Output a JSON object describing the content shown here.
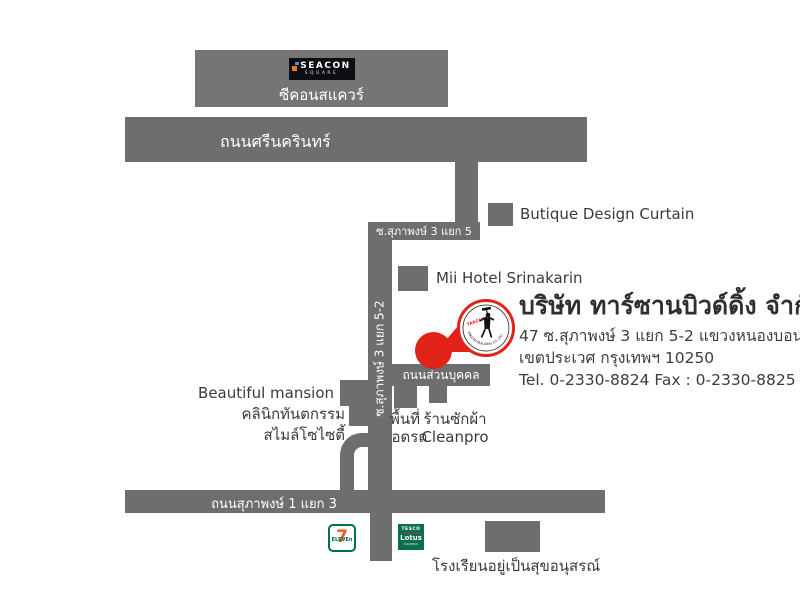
{
  "colors": {
    "road": "#6e6e6e",
    "marker_red": "#e2231a",
    "text_dark": "#3a3a3a",
    "seven_green": "#00703c",
    "seven_orange": "#f05a22",
    "tesco_green": "#0b6e4f"
  },
  "seacon": {
    "brand_top": "SEACON",
    "brand_bottom": "SQUARE",
    "label": "ซีคอนสแควร์"
  },
  "roads": {
    "srinakarin": "ถนนศรีนครินทร์",
    "soi_suphaphong_3_yaek_5": "ซ.สุภาพงษ์ 3 แยก 5",
    "soi_suphaphong_3_yaek_5_2": "ซ.สุภาพงษ์ 3 แยก 5-2",
    "private_road": "ถนนส่วนบุคคล",
    "suphaphong_1_yaek_3": "ถนนสุภาพงษ์ 1 แยก 3"
  },
  "places": {
    "butique": "Butique Design Curtain",
    "mii_hotel": "Mii Hotel Srinakarin",
    "beautiful_mansion": "Beautiful mansion",
    "clinic_line1": "คลินิกทันตกรรม",
    "clinic_line2": "สไมล์โซไซตี้",
    "parking_line1": "พื้นที่",
    "parking_line2": "จอดรถ",
    "laundry_line1": "ร้านซักผ้า",
    "laundry_line2": "Cleanpro",
    "school": "โรงเรียนอยู่เป็นสุขอนุสรณ์"
  },
  "brands": {
    "seven_eleven_seven": "7",
    "seven_eleven_eleven": "ELEVEn",
    "tesco_line1": "TESCO",
    "tesco_line2": "Lotus",
    "tesco_line3": "Express"
  },
  "company": {
    "name": "บริษัท ทาร์ซานบิวด์ดิ้ง จำกัด",
    "address1": "47 ซ.สุภาพงษ์ 3 แยก 5-2 แขวงหนองบอน",
    "address2": "เขตประเวศ กรุงเทพฯ 10250",
    "contact": "Tel. 0-2330-8824 Fax : 0-2330-8825",
    "logo_name": "TARZAN",
    "logo_ring_text": "TARZAN BUILDING CO.,LTD."
  }
}
